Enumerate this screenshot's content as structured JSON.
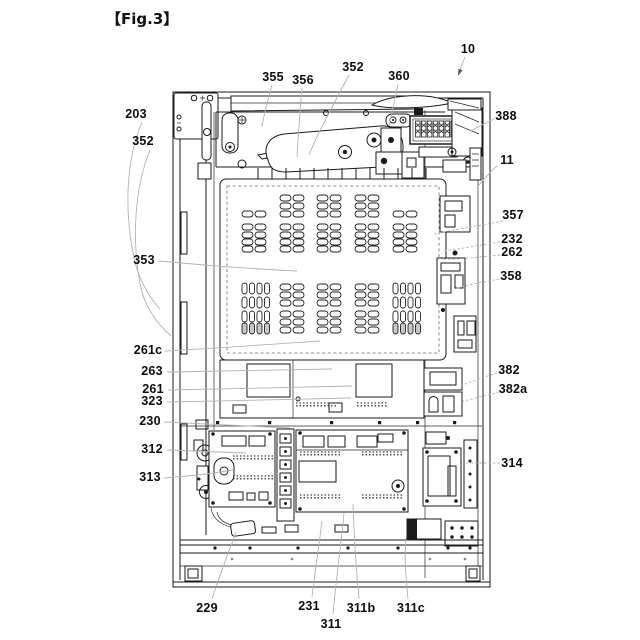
{
  "figure": {
    "title": "【Fig.3】"
  },
  "colors": {
    "line": "#1a1a1a",
    "leader": "#b3b3b3",
    "arrow": "#5a5a5a",
    "background": "#ffffff",
    "label_text": "#0d0d0d"
  },
  "labels": [
    {
      "id": "10",
      "text": "10",
      "x": 468,
      "y": 49,
      "leader": "M465,57 L459,72",
      "arrow": "M458,76 L458.5,68.7 L462.6,70.3 Z"
    },
    {
      "id": "355",
      "text": "355",
      "x": 273,
      "y": 77,
      "leader": "M272,85 C268,100 264,113 262,127"
    },
    {
      "id": "356",
      "text": "356",
      "x": 303,
      "y": 80,
      "leader": "M302,88 C300,112 298,135 297,157"
    },
    {
      "id": "352t",
      "text": "352",
      "x": 353,
      "y": 67,
      "leader": "M349,75 C336,100 318,132 309,155"
    },
    {
      "id": "360",
      "text": "360",
      "x": 399,
      "y": 76,
      "leader": "M398,84 C395,98 392,113 389,126"
    },
    {
      "id": "388",
      "text": "388",
      "x": 506,
      "y": 116,
      "leader": "M494,119 C486,123 478,127 470,131"
    },
    {
      "id": "11",
      "text": "11",
      "x": 507,
      "y": 160,
      "leader": "M497,166 C490,172 484,179 478,186"
    },
    {
      "id": "357",
      "text": "357",
      "x": 513,
      "y": 215,
      "leader": "M503,221 C478,226 452,230 433,234",
      "dashed": true
    },
    {
      "id": "232",
      "text": "232",
      "x": 512,
      "y": 239,
      "leader": "M500,242 C480,245 460,249 443,251",
      "dashed": true
    },
    {
      "id": "262",
      "text": "262",
      "x": 512,
      "y": 252,
      "leader": "M500,255 C479,257 458,260 441,259",
      "dashed": true
    },
    {
      "id": "358",
      "text": "358",
      "x": 511,
      "y": 276,
      "leader": "M499,279 C483,282 466,285 455,289",
      "dashed": true
    },
    {
      "id": "382",
      "text": "382",
      "x": 509,
      "y": 370,
      "leader": "M497,373 C484,377 470,382 460,386",
      "dashed": true
    },
    {
      "id": "382a",
      "text": "382a",
      "x": 513,
      "y": 389,
      "leader": "M499,392 C487,395 473,399 463,401",
      "dashed": true
    },
    {
      "id": "314",
      "text": "314",
      "x": 512,
      "y": 463,
      "leader": "M500,463 L462,463",
      "dashed": true
    },
    {
      "id": "203",
      "text": "203",
      "x": 136,
      "y": 114,
      "leader": "M142,122 C126,160 124,210 134,258 C138,276 147,295 160,309"
    },
    {
      "id": "352l",
      "text": "352",
      "x": 143,
      "y": 141,
      "leader": "M150,150 C134,190 132,240 140,284 C144,304 155,322 171,336"
    },
    {
      "id": "353",
      "text": "353",
      "x": 144,
      "y": 260,
      "leader": "M159,261 C200,265 255,269 297,271"
    },
    {
      "id": "261c",
      "text": "261c",
      "x": 148,
      "y": 350,
      "leader": "M165,351 C220,348 276,344 320,341"
    },
    {
      "id": "263",
      "text": "263",
      "x": 152,
      "y": 371,
      "leader": "M167,372 C225,371 286,370 332,369"
    },
    {
      "id": "261",
      "text": "261",
      "x": 153,
      "y": 389,
      "leader": "M168,390 C230,389 300,387 352,386"
    },
    {
      "id": "323",
      "text": "323",
      "x": 152,
      "y": 401,
      "leader": "M167,402 C230,401 298,399 351,398"
    },
    {
      "id": "230",
      "text": "230",
      "x": 150,
      "y": 421,
      "leader": "M164,422 C210,424 256,426 290,428"
    },
    {
      "id": "312",
      "text": "312",
      "x": 152,
      "y": 449,
      "leader": "M167,450 L246,453"
    },
    {
      "id": "313",
      "text": "313",
      "x": 150,
      "y": 477,
      "leader": "M164,478 C190,476 216,473 233,470"
    },
    {
      "id": "229",
      "text": "229",
      "x": 207,
      "y": 608,
      "leader": "M212,599 C219,577 228,554 236,532"
    },
    {
      "id": "231",
      "text": "231",
      "x": 309,
      "y": 606,
      "leader": "M312,597 C315,572 319,546 322,521"
    },
    {
      "id": "311",
      "text": "311",
      "x": 331,
      "y": 624,
      "leader": "M333,614 C336,580 341,545 344,513"
    },
    {
      "id": "311b",
      "text": "311b",
      "x": 361,
      "y": 608,
      "leader": "M359,599 C356,567 354,535 353,504"
    },
    {
      "id": "311c",
      "text": "311c",
      "x": 411,
      "y": 608,
      "leader": "M408,599 C406,578 404,557 406,538"
    }
  ]
}
